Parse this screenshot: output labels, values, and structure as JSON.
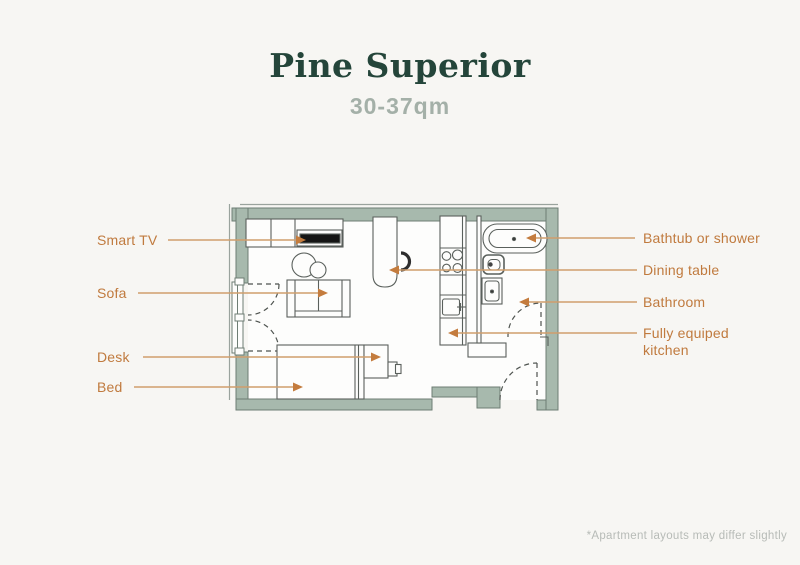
{
  "header": {
    "title": "Pine Superior",
    "subtitle": "30-37qm"
  },
  "labels": {
    "smart_tv": "Smart TV",
    "sofa": "Sofa",
    "desk": "Desk",
    "bed": "Bed",
    "bathtub": "Bathtub or shower",
    "dining_table": "Dining table",
    "bathroom": "Bathroom",
    "kitchen": "Fully equiped kitchen"
  },
  "footer": {
    "note": "*Apartment layouts may differ slightly"
  },
  "colors": {
    "background": "#f7f6f3",
    "title": "#24453a",
    "subtitle": "#a4b0a8",
    "label_text": "#c07a3e",
    "leader_line": "#d09e6c",
    "arrowhead": "#c47c3e",
    "wall_fill": "#a7b9ad",
    "wall_outline": "#6e7d74",
    "furniture_outline": "#5a605c",
    "tv_screen": "#151515",
    "footnote_text": "#b7bbb7"
  }
}
